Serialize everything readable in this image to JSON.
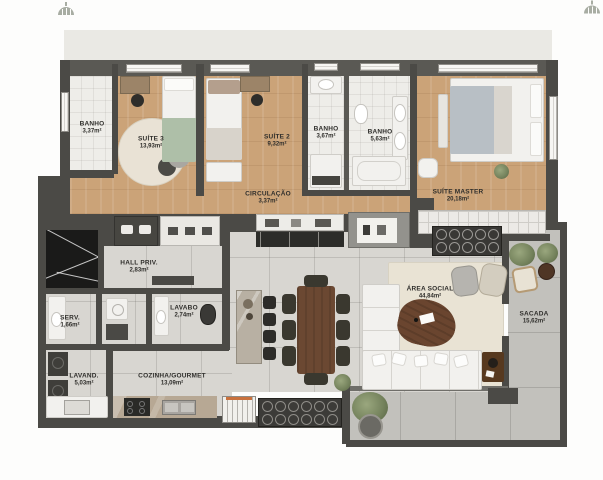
{
  "rooms": {
    "banho_suite3": {
      "name": "BANHO",
      "area": "3,37m²"
    },
    "suite3": {
      "name": "SUÍTE 3",
      "area": "13,93m²"
    },
    "suite2": {
      "name": "SUÍTE 2",
      "area": "9,32m²"
    },
    "banho_suite2": {
      "name": "BANHO",
      "area": "3,67m²"
    },
    "banho_master": {
      "name": "BANHO",
      "area": "5,63m²"
    },
    "suite_master": {
      "name": "SUÍTE MASTER",
      "area": "20,18m²"
    },
    "circulacao": {
      "name": "CIRCULAÇÃO",
      "area": "3,37m²"
    },
    "hall_priv": {
      "name": "HALL PRIV.",
      "area": "2,83m²"
    },
    "lavabo": {
      "name": "LAVABO",
      "area": "2,74m²"
    },
    "serv": {
      "name": "SERV.",
      "area": "1,66m²"
    },
    "lavand": {
      "name": "LAVAND.",
      "area": "5,03m²"
    },
    "cozinha": {
      "name": "COZINHA/GOURMET",
      "area": "13,09m²"
    },
    "area_social": {
      "name": "ÁREA SOCIAL",
      "area": "44,84m²"
    },
    "sacada": {
      "name": "SACADA",
      "area": "15,62m²"
    }
  },
  "icons": {
    "top_left": "house-logo-icon",
    "top_right": "house-logo-icon"
  },
  "colors": {
    "wall": "#4b4a46",
    "wood_floor": "#cba378",
    "tile_floor": "#d8d6d1",
    "bathroom_floor": "#eeede9",
    "rug": "#e9e3d4",
    "balcony_floor": "#c2c1bc",
    "marble_black": "#1a1a19",
    "plaster": "#eae9e4",
    "plant_green": "#74825c",
    "dining_wood": "#6b4832",
    "label_text": "#2f2e2b"
  }
}
